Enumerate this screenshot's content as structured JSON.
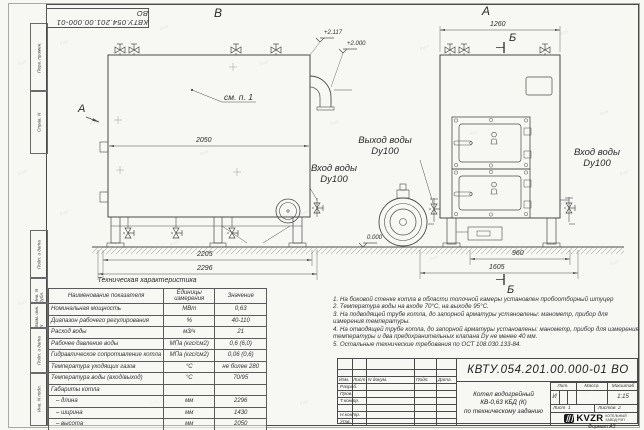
{
  "doc_number": "КВТУ.054.201.00.000-01 ВО",
  "watermark": "kvzr",
  "frame": {
    "boxes": [
      "Перв. примен.",
      "Справ. N",
      "Подп. и дата",
      "Инв. N дубл.",
      "Взам. инв. N",
      "Подп. и дата",
      "Инв. N подл."
    ]
  },
  "views": {
    "left": {
      "label": "В",
      "section_label": "А",
      "see_note": "см. п. 1",
      "dims": {
        "inner": "2050",
        "base1": "2205",
        "base2": "2296"
      }
    },
    "right": {
      "label": "А",
      "section_label": "Б",
      "dims": {
        "top": "1260",
        "base1": "960",
        "base2": "1605"
      }
    }
  },
  "elevations": {
    "top1": "+2.117",
    "top2": "+2.000",
    "ground": "0.000"
  },
  "pipes": {
    "outlet": [
      "Выход воды",
      "Dy100"
    ],
    "inlet": [
      "Вход воды",
      "Dy100"
    ]
  },
  "table": {
    "title": "Техническая характеристика",
    "headers": [
      "Наименование показателя",
      "Единицы измерения",
      "Значение"
    ],
    "rows": [
      [
        "Номинальная мощность",
        "МВт",
        "0,63"
      ],
      [
        "Диапазон рабочего регулирования",
        "%",
        "40-110"
      ],
      [
        "Расход воды",
        "м3/ч",
        "21"
      ],
      [
        "Рабочее давление воды",
        "МПа (кгс/см2)",
        "0,6 (6,0)"
      ],
      [
        "Гидравлическое сопротивление котла",
        "МПа (кгс/см2)",
        "0,06 (0,6)"
      ],
      [
        "Температура уходящих газов",
        "°С",
        "не более 280"
      ],
      [
        "Температура воды (вход/выход)",
        "°С",
        "70/95"
      ],
      [
        "Габариты котла",
        "",
        ""
      ],
      [
        "   – длина",
        "мм",
        "2296"
      ],
      [
        "   – ширина",
        "мм",
        "1430"
      ],
      [
        "   – высота",
        "мм",
        "2050"
      ]
    ]
  },
  "notes": [
    "1.  На боковой стенке котла в области топочной камеры установлен пробоотборный штуцер",
    "2.  Температура воды на входе 70°С, на выходе 95°С.",
    "3.  На подводящей трубе котла, до запорной арматуры установлены: манометр, прибор для измерения температуры.",
    "4.  На отводящей трубе котла, до запорной арматуры установлены: манометр, прибор для измерения температуры и два предохранительных клапана Dу не менее 40 мм.",
    "5.  Остальные технические требования по ОСТ 108.030.133-84."
  ],
  "titleblock": {
    "rev_headers": [
      "Изм.",
      "Лист",
      "N докум.",
      "Подп.",
      "Дата"
    ],
    "sig_rows": [
      "Разраб.",
      "Пров.",
      "Т.контр.",
      "",
      "Н.контр.",
      "Утв."
    ],
    "title_lines": [
      "Котел водогрейный",
      "КВ-0,63 КБД (К)",
      "по техническому заданию"
    ],
    "lit_headers": [
      "Лит.",
      "Масса",
      "Масштаб"
    ],
    "lit_value": "И",
    "mass_value": "",
    "scale_value": "1:15",
    "sheet_label": "Лист",
    "sheet_value": "1",
    "sheets_label": "Листов",
    "sheets_value": "2",
    "format_note": "Формат  А3"
  },
  "logo": {
    "text": "KVZR",
    "caption1": "КОТЕЛЬНЫЙ",
    "caption2": "ЗАВОД РЭП"
  }
}
